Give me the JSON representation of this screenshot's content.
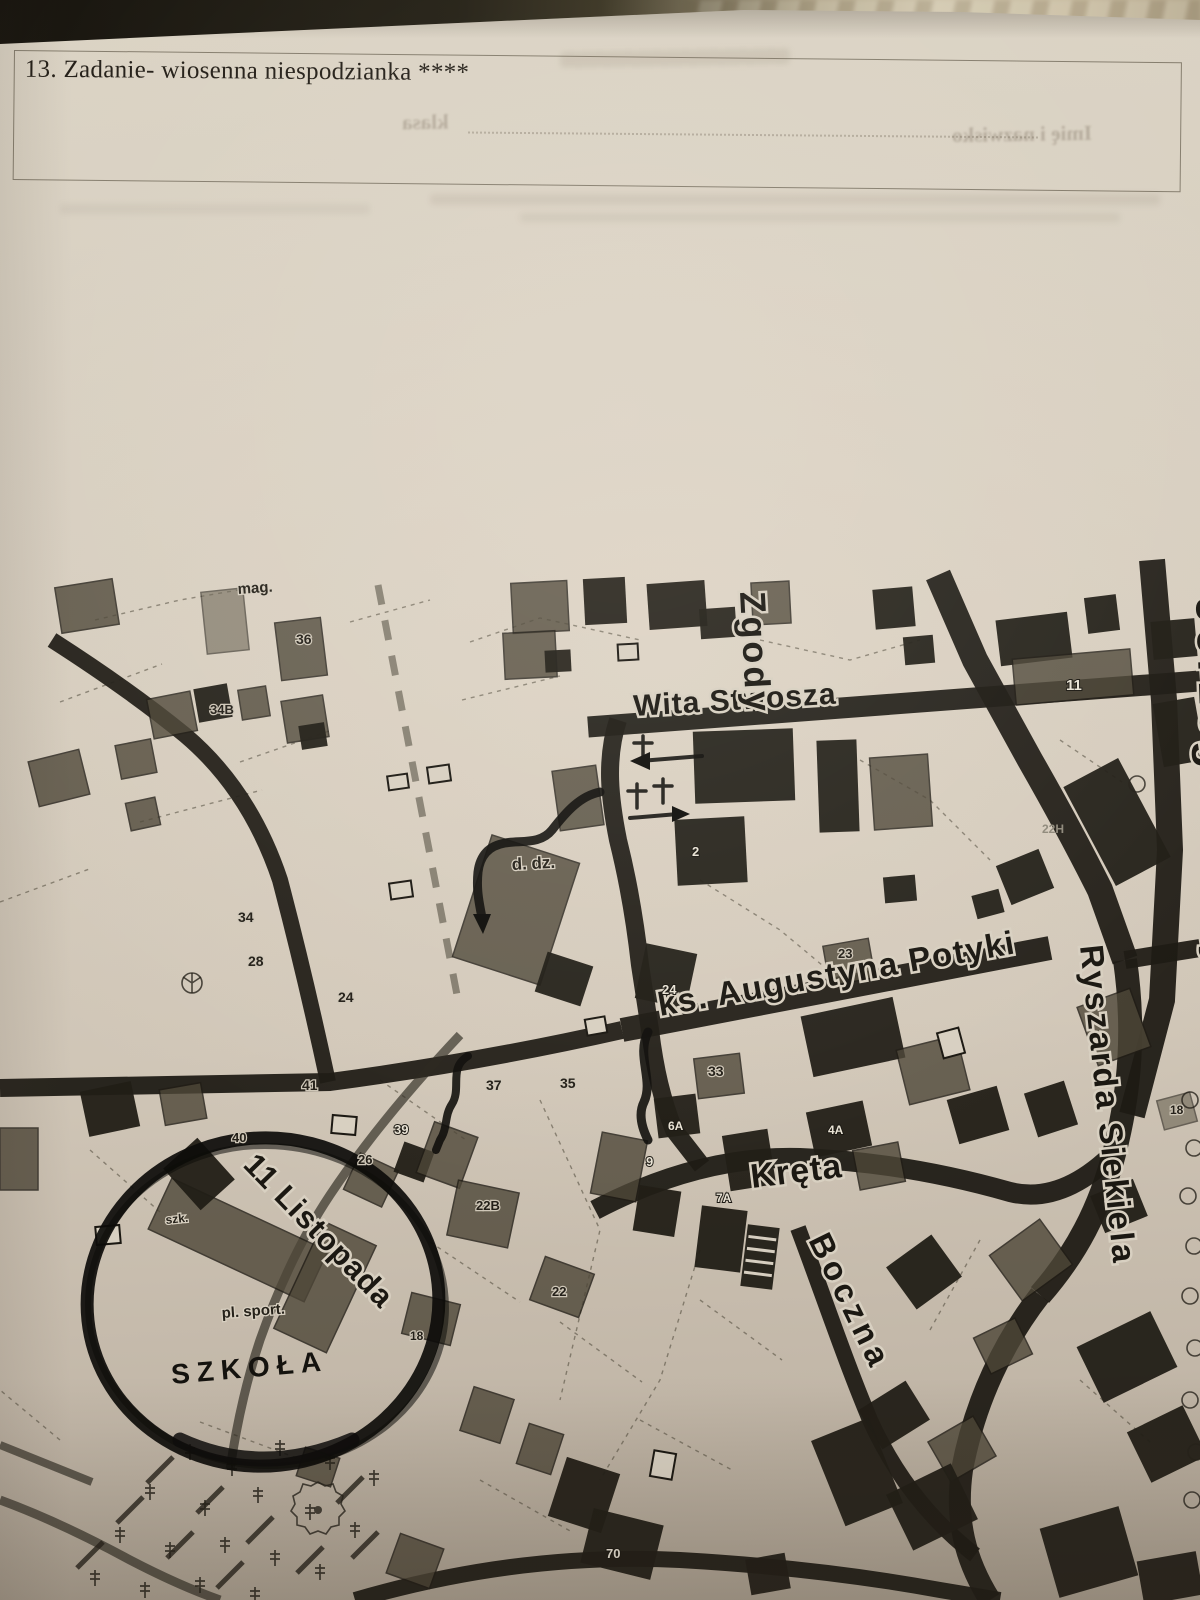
{
  "task_box": {
    "title": "13. Zadanie- wiosenna niespodzianka ****"
  },
  "ghost_bleedthrough": {
    "name_label": "Imię i nazwisko",
    "class_label": "klasa"
  },
  "map": {
    "ink_color": "#1e1b14",
    "paper_color": "#d5ccbd",
    "marker_color": "#0f0e0b",
    "street_labels": [
      {
        "id": "wita-stwosza",
        "text": "Wita Stwosza",
        "x": 634,
        "y": 716,
        "rotate": -3.5,
        "size": 30,
        "spacing": 1
      },
      {
        "id": "zgody",
        "text": "Zgody",
        "x": 740,
        "y": 592,
        "rotate": 87,
        "size": 36,
        "spacing": 3
      },
      {
        "id": "jerzego-drazy",
        "text": "Jerzego Drazy",
        "x": 1196,
        "y": 598,
        "rotate": 88,
        "size": 46,
        "spacing": 5
      },
      {
        "id": "ks-augustyna-potyki",
        "text": "ks. Augustyna Potyki",
        "x": 660,
        "y": 1016,
        "rotate": -10,
        "size": 33,
        "spacing": 1.5
      },
      {
        "id": "ryszarda-siekiela",
        "text": "Ryszarda Siekiela",
        "x": 1080,
        "y": 946,
        "rotate": 84,
        "size": 33,
        "spacing": 2.5
      },
      {
        "id": "kreta",
        "text": "Kręta",
        "x": 752,
        "y": 1188,
        "rotate": -7,
        "size": 34,
        "spacing": 1
      },
      {
        "id": "boczna",
        "text": "Boczna",
        "x": 808,
        "y": 1240,
        "rotate": 64,
        "size": 33,
        "spacing": 5
      },
      {
        "id": "11-listopada",
        "text": "11 Listopada",
        "x": 242,
        "y": 1166,
        "rotate": 46,
        "size": 31,
        "spacing": 1
      }
    ],
    "place_labels": [
      {
        "id": "mag",
        "text": "mag.",
        "x": 238,
        "y": 594,
        "size": 15,
        "rotate": -4
      },
      {
        "id": "d-dz",
        "text": "d. dz.",
        "x": 512,
        "y": 870,
        "size": 17,
        "rotate": -3
      },
      {
        "id": "szk",
        "text": "szk.",
        "x": 166,
        "y": 1224,
        "size": 12,
        "rotate": -6
      },
      {
        "id": "pl-sport",
        "text": "pl. sport.",
        "x": 222,
        "y": 1318,
        "size": 15,
        "rotate": -4
      },
      {
        "id": "szkola",
        "text": "SZKOŁA",
        "x": 172,
        "y": 1384,
        "size": 28,
        "rotate": -5,
        "hand": true
      }
    ],
    "building_numbers": [
      {
        "text": "36",
        "x": 296,
        "y": 644,
        "size": 14
      },
      {
        "text": "34B",
        "x": 210,
        "y": 714,
        "size": 13
      },
      {
        "text": "34",
        "x": 238,
        "y": 922,
        "size": 14
      },
      {
        "text": "28",
        "x": 248,
        "y": 966,
        "size": 14
      },
      {
        "text": "24",
        "x": 338,
        "y": 1002,
        "size": 14
      },
      {
        "text": "26",
        "x": 358,
        "y": 1164,
        "size": 13
      },
      {
        "text": "41",
        "x": 302,
        "y": 1090,
        "size": 14
      },
      {
        "text": "40",
        "x": 232,
        "y": 1142,
        "size": 13
      },
      {
        "text": "39",
        "x": 394,
        "y": 1134,
        "size": 13,
        "white": true
      },
      {
        "text": "37",
        "x": 486,
        "y": 1090,
        "size": 14
      },
      {
        "text": "35",
        "x": 560,
        "y": 1088,
        "size": 14
      },
      {
        "text": "33",
        "x": 708,
        "y": 1076,
        "size": 14
      },
      {
        "text": "22B",
        "x": 476,
        "y": 1210,
        "size": 13
      },
      {
        "text": "22",
        "x": 552,
        "y": 1296,
        "size": 13
      },
      {
        "text": "24",
        "x": 662,
        "y": 994,
        "size": 13,
        "white": true
      },
      {
        "text": "23",
        "x": 838,
        "y": 958,
        "size": 13
      },
      {
        "text": "2",
        "x": 692,
        "y": 856,
        "size": 13,
        "white": true
      },
      {
        "text": "9",
        "x": 646,
        "y": 1166,
        "size": 13,
        "white": true
      },
      {
        "text": "6A",
        "x": 668,
        "y": 1130,
        "size": 12,
        "white": true
      },
      {
        "text": "4A",
        "x": 828,
        "y": 1134,
        "size": 12,
        "white": true
      },
      {
        "text": "7A",
        "x": 716,
        "y": 1202,
        "size": 12,
        "white": true
      },
      {
        "text": "11",
        "x": 1066,
        "y": 690,
        "size": 15,
        "white": true
      },
      {
        "text": "22H",
        "x": 1042,
        "y": 833,
        "size": 12,
        "dim": true
      },
      {
        "text": "18",
        "x": 1170,
        "y": 1114,
        "size": 12
      },
      {
        "text": "18",
        "x": 410,
        "y": 1340,
        "size": 12
      },
      {
        "text": "70",
        "x": 606,
        "y": 1558,
        "size": 13,
        "white": true
      }
    ]
  }
}
